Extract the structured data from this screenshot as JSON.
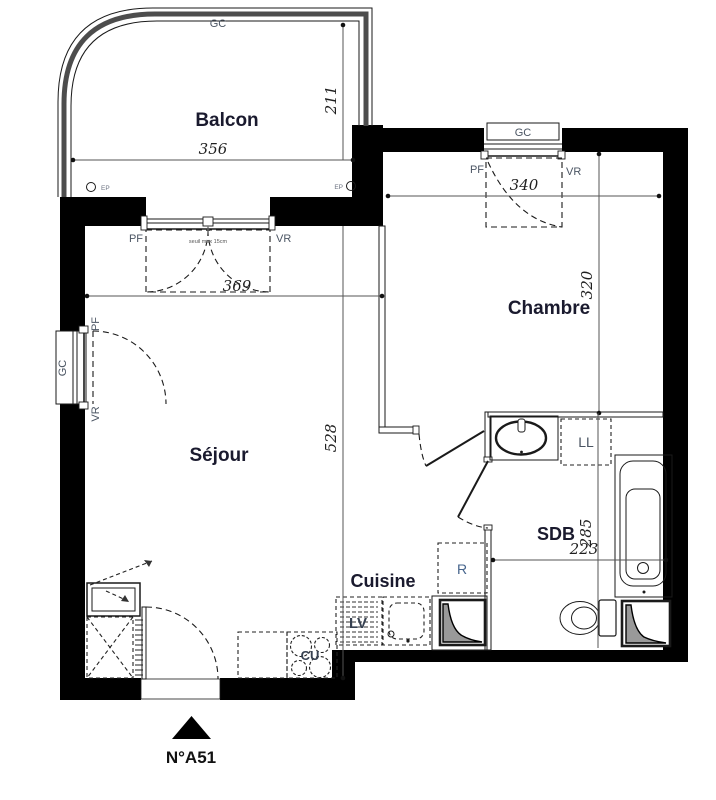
{
  "unit": {
    "number": "N°A51"
  },
  "rooms": {
    "balcon": "Balcon",
    "chambre": "Chambre",
    "sejour": "Séjour",
    "cuisine": "Cuisine",
    "sdb": "SDB"
  },
  "dimensions": {
    "balcon_width": "356",
    "balcon_depth": "211",
    "sejour_width": "369",
    "sejour_depth": "528",
    "chambre_width": "340",
    "chambre_depth": "320",
    "sdb_depth": "285",
    "sdb_width": "223"
  },
  "labels": {
    "gc": "GC",
    "pf": "PF",
    "vr": "VR",
    "ep": "EP",
    "ll": "LL",
    "lv": "LV",
    "cu": "CU",
    "r": "R",
    "seuil": "seuil max 15cm"
  },
  "colors": {
    "wall": "#000000",
    "line": "#1a1a1a",
    "dim_line": "#555555",
    "small_label": "#4b5563",
    "room_label": "#1a1a2e",
    "railing": "#4d4d4d",
    "duct_fill": "#999999"
  }
}
